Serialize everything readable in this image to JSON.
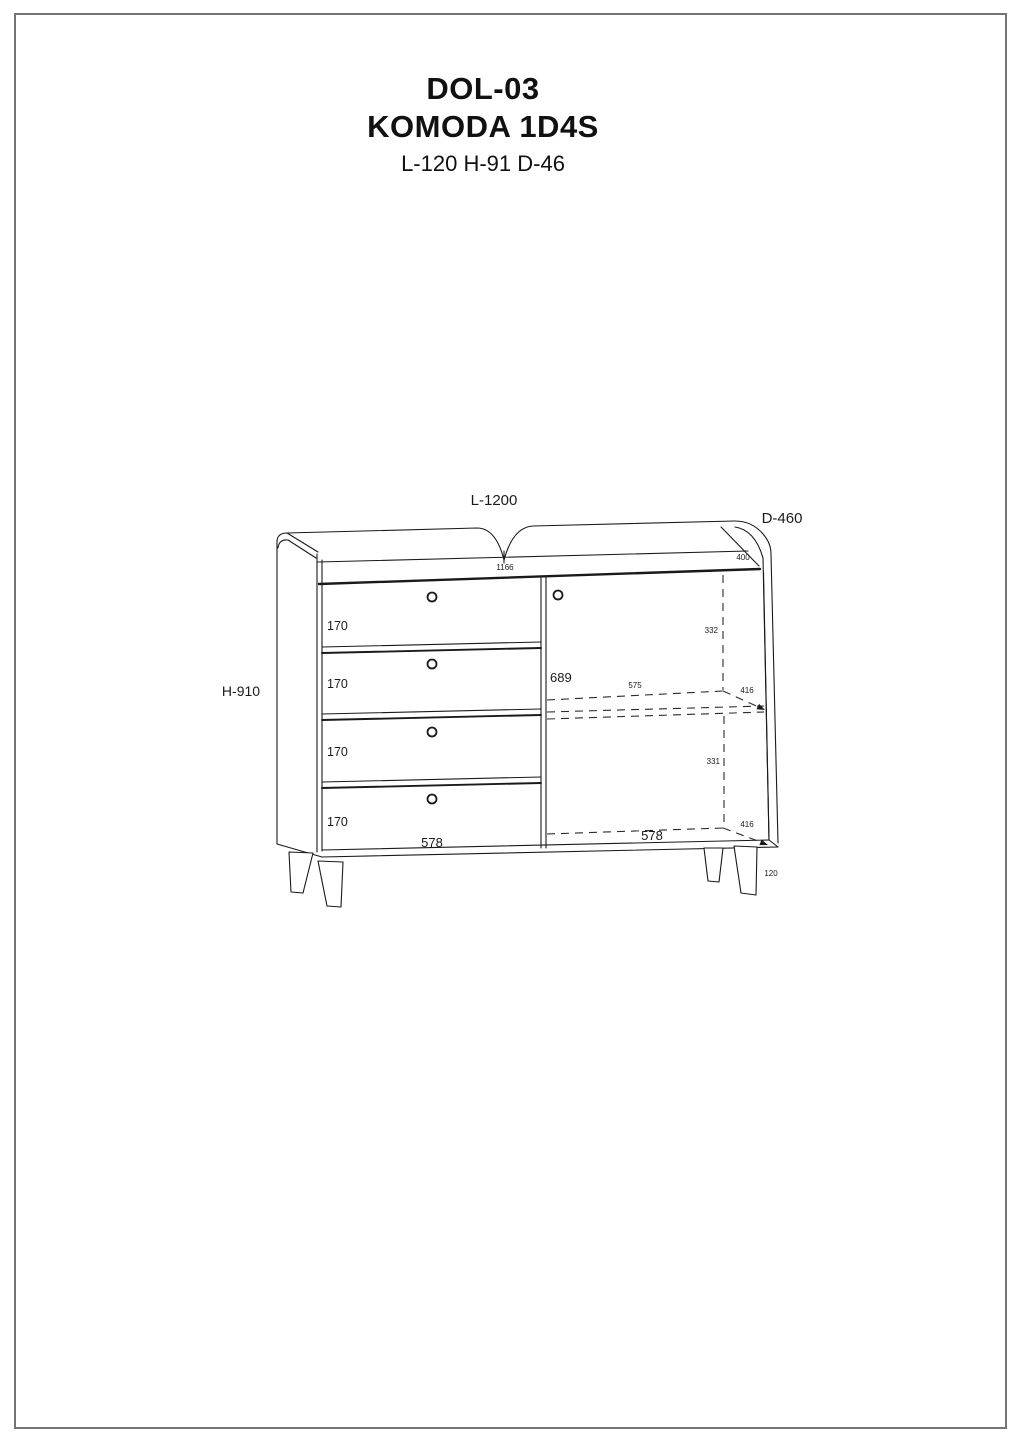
{
  "header": {
    "model_code": "DOL-03",
    "product_name": "KOMODA 1D4S",
    "overall_dims": "L-120 H-91 D-46"
  },
  "drawing": {
    "dimensions": {
      "length": "L-1200",
      "depth": "D-460",
      "height": "H-910",
      "top_width": "1166",
      "top_depth": "400",
      "drawer_heights": [
        "170",
        "170",
        "170",
        "170"
      ],
      "door_interior_height": "689",
      "shelf_width": "575",
      "upper_compartment_height": "332",
      "shelf_depth_upper": "416",
      "lower_compartment_height": "331",
      "drawer_section_width": "578",
      "door_section_width": "578",
      "shelf_depth_lower": "416",
      "leg_height": "120"
    },
    "colors": {
      "line": "#1a1a1a",
      "background": "#ffffff",
      "page_border": "#757575"
    }
  }
}
